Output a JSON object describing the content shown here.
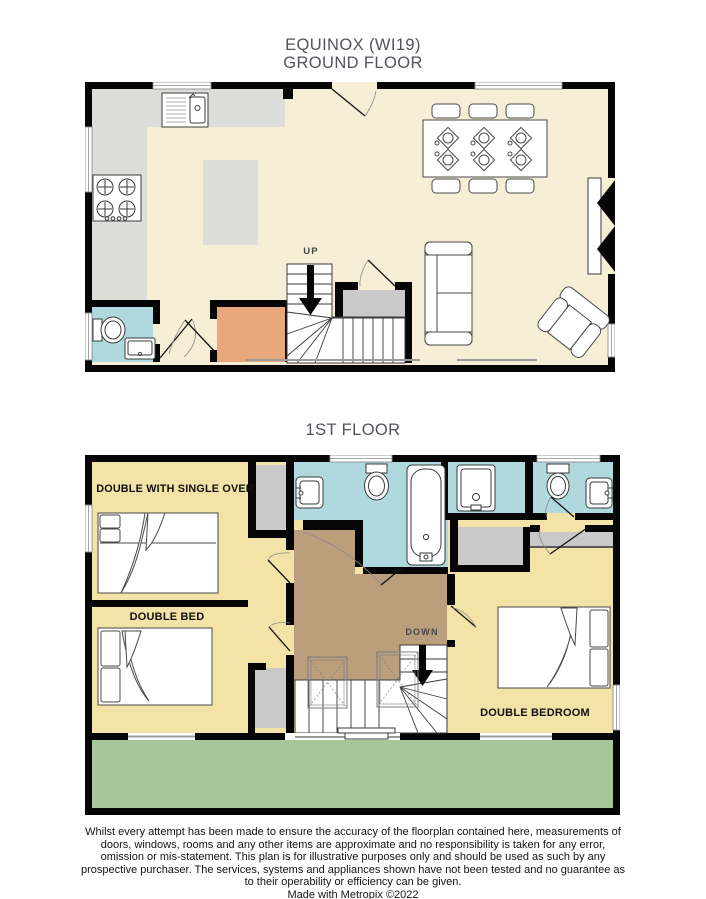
{
  "header": {
    "line1": "EQUINOX (WI19)",
    "line2": "GROUND FLOOR"
  },
  "ground_floor": {
    "up_label": "UP"
  },
  "first_floor": {
    "heading": "1ST FLOOR",
    "down_label": "DOWN",
    "room_labels": {
      "top_left": "DOUBLE WITH SINGLE OVER",
      "mid_left": "DOUBLE BED",
      "right": "DOUBLE BEDROOM"
    }
  },
  "colors": {
    "wall": "#060606",
    "gf_floor": "#F7EFD5",
    "kitchen": "#DDDDD9",
    "bathroom": "#AFD9DF",
    "entrance": "#E9A87B",
    "bedroom": "#F3E3A6",
    "landing": "#BB9F7D",
    "terrace": "#A6C79C",
    "wardrobe": "#C9C9C9"
  },
  "footer": {
    "disclaimer": "Whilst every attempt has been made to ensure the accuracy of the floorplan contained here, measurements of doors, windows, rooms and any other items are approximate and no responsibility is taken for any error, omission or mis-statement. This plan is for illustrative purposes only and should be used as such by any prospective purchaser. The services, systems and appliances shown have not been tested and no guarantee as to their operability or efficiency can be given.",
    "credit": "Made with Metropix ©2022"
  }
}
